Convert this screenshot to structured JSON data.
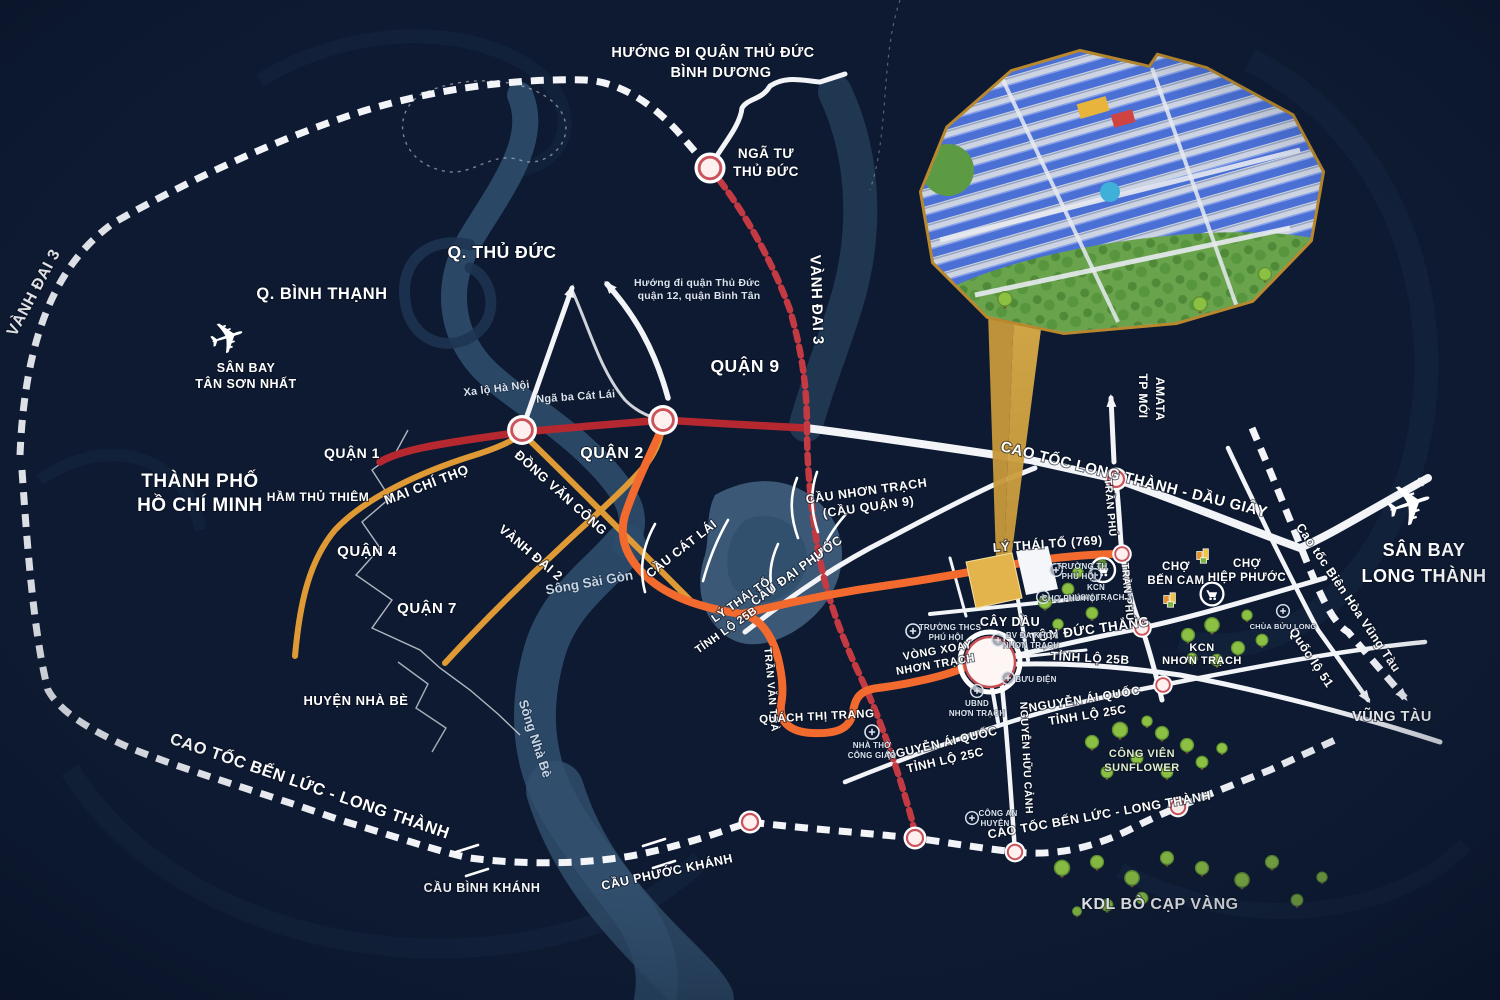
{
  "map": {
    "bg": "#0d1a31",
    "road_white": "#f2f4f8",
    "road_red": "#b5282f",
    "road_red_dashed": "#c33a42",
    "road_amber": "#e09a35",
    "road_orange": "#f26a2e",
    "gold": "#d9a43c",
    "river": "#2c4b69"
  },
  "districts": {
    "binh_thanh": "Q. BÌNH THẠNH",
    "thu_duc": "Q. THỦ ĐỨC",
    "quan_9": "QUẬN 9",
    "quan_1": "QUẬN 1",
    "quan_2": "QUẬN 2",
    "quan_4": "QUẬN 4",
    "quan_7": "QUẬN 7",
    "hcmc_1": "THÀNH PHỐ",
    "hcmc_2": "HỒ CHÍ MINH",
    "nha_be": "HUYỆN NHÀ BÈ"
  },
  "airports": {
    "tsn_1": "SÂN BAY",
    "tsn_2": "TÂN SƠN NHẤT",
    "lt_1": "SÂN BAY",
    "lt_2": "LONG THÀNH"
  },
  "directions": {
    "north_1": "HƯỚNG ĐI QUẬN THỦ ĐỨC",
    "north_2": "BÌNH DƯƠNG",
    "west_small_1": "Hướng đi quận Thủ Đức",
    "west_small_2": "quận 12, quận Bình Tân",
    "vung_tau": "VŨNG TÀU"
  },
  "junctions": {
    "nga_tu_1": "NGÃ TƯ",
    "nga_tu_2": "THỦ ĐỨC",
    "nga_ba_cat_lai": "Ngã ba Cát Lái",
    "xa_lo_ha_noi": "Xa lộ Hà Nội",
    "vong_xoay_1": "VÒNG XOAY",
    "vong_xoay_2": "NHƠN TRẠCH"
  },
  "roads": {
    "ring3_left": "VÀNH ĐAI 3",
    "ring3_mid": "VÀNH ĐAI 3",
    "ring2": "VÀNH ĐAI 2",
    "mai_chi_tho": "MAI CHÍ THỌ",
    "ham_thu_thiem": "HẦM THỦ THIÊM",
    "dong_van_cong": "ĐỒNG VĂN CÔNG",
    "ly_thai_to": "LÝ THÁI TỔ",
    "ly_thai_to_769": "LÝ THÁI TỔ (769)",
    "tl25b_w": "TỈNH LỘ 25B",
    "tl25b_e": "TỈNH LỘ 25B",
    "tran_van_tra": "TRẦN VĂN TRÀ",
    "quach_thi_trang": "QUÁCH THỊ TRANG",
    "ton_duc_thang": "TÔN ĐỨC THẮNG",
    "nguyen_ai_quoc_w": "NGUYỄN ÁI QUỐC",
    "tl25c_w": "TỈNH LỘ 25C",
    "nguyen_ai_quoc_e": "NGUYỄN ÁI QUỐC",
    "tl25c_e": "TỈNH LỘ 25C",
    "nguyen_huu_canh": "NGUYỄN HỮU CẢNH",
    "tran_phu_1": "TRẦN PHÚ",
    "tran_phu_2": "TRẦN PHÚ",
    "lt_daugiay": "CAO TỐC LONG THÀNH - DẦU GIÂY",
    "benluc_lt_w": "CAO TỐC BẾN LỨC - LONG THÀNH",
    "benluc_lt_e": "CAO TỐC BẾN LỨC - LONG THÀNH",
    "bienhoa_vungtau": "Cao tốc Biên Hòa Vũng Tàu",
    "quoc_lo_51": "Quốc lộ 51",
    "amata_1": "TP MỚI",
    "amata_2": "AMATA"
  },
  "bridges": {
    "cat_lai": "CẦU CÁT LÁI",
    "dai_phuoc": "CẦU ĐẠI PHƯỚC",
    "nhon_trach_1": "CẦU NHƠN TRẠCH",
    "nhon_trach_2": "(CẦU QUẬN 9)",
    "binh_khanh": "CẦU BÌNH KHÁNH",
    "phuoc_khanh": "CẦU PHƯỚC KHÁNH"
  },
  "rivers": {
    "saigon": "Sông Sài Gòn",
    "nha_be": "Sông Nhà Bè"
  },
  "pois": {
    "cho_ben_cam_1": "CHỢ",
    "cho_ben_cam_2": "BẾN CAM",
    "cho_hiep_phuoc_1": "CHỢ",
    "cho_hiep_phuoc_2": "HIỆP PHƯỚC",
    "cay_dau": "CÂY DẦU",
    "kcn_nt_1": "KCN",
    "kcn_nt_2": "NHƠN TRẠCH",
    "cv_sunflower_1": "CÔNG VIÊN",
    "cv_sunflower_2": "SUNFLOWER",
    "kdl_bo_cap_vang": "KDL BÒ CẠP VÀNG",
    "truong_thcs_1": "TRƯỜNG THCS",
    "truong_thcs_2": "PHÚ HỘI",
    "truong_th_1": "TRƯỜNG TH",
    "truong_th_2": "PHÚ HỘI",
    "kcn_nt3_1": "KCN",
    "kcn_nt3_2": "NHƠN TRẠCH 3",
    "cho_phu_hoi": "CHỢ PHÚ HỘI",
    "bv_1": "BV ĐA KHOA",
    "bv_2": "NHƠN TRẠCH",
    "ubnd_1": "UBND",
    "ubnd_2": "NHƠN TRẠCH",
    "buu_dien": "BƯU ĐIỆN",
    "nha_tho_1": "NHÀ THỜ",
    "nha_tho_2": "CÔNG GIÁO",
    "cong_an_1": "CÔNG AN",
    "cong_an_2": "HUYỆN",
    "chua_buu_long": "CHÙA BỬU LONG"
  },
  "icons": {
    "plane": "✈"
  }
}
